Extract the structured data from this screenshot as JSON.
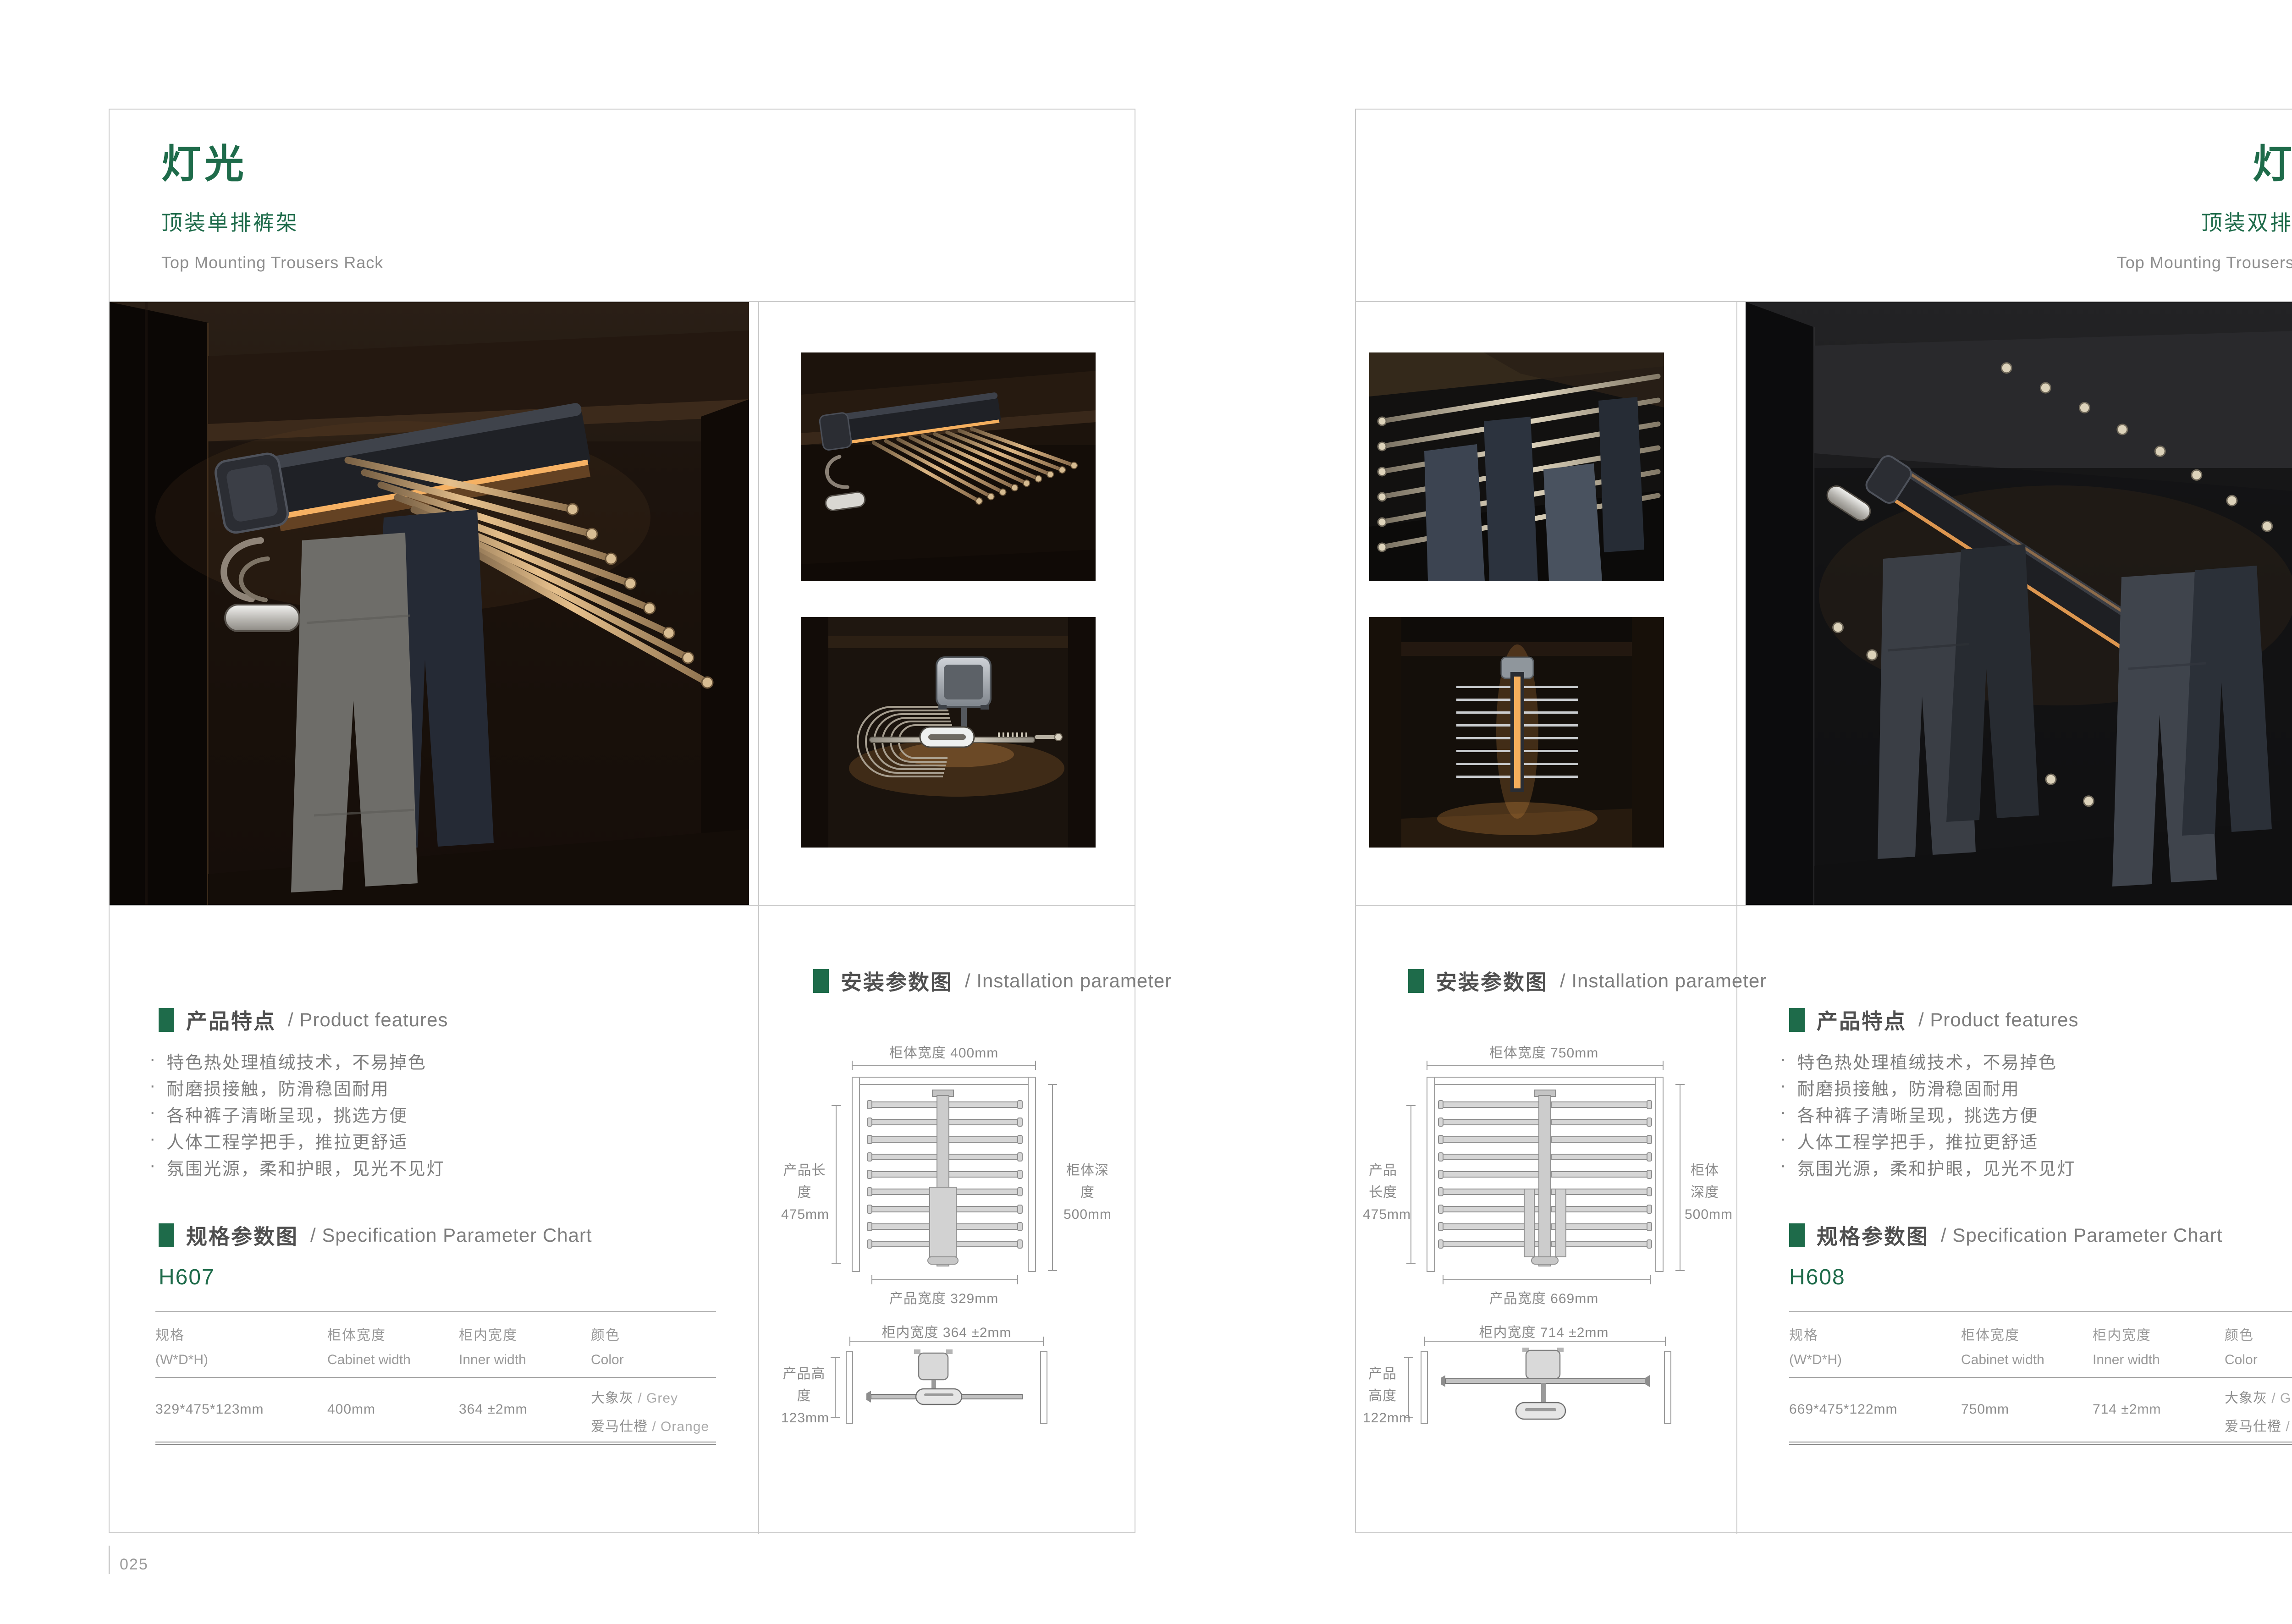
{
  "ui": {
    "bullet_glyph": "·",
    "accent_green": "#1e6b4a"
  },
  "shared": {
    "features_heading": {
      "zh": "产品特点",
      "en": "/  Product features"
    },
    "spec_heading": {
      "zh": "规格参数图",
      "en": "/ Specification Parameter Chart"
    },
    "install_heading": {
      "zh": "安装参数图",
      "en": "/  Installation parameter"
    },
    "feature_items": [
      "特色热处理植绒技术，不易掉色",
      "耐磨损接触，防滑稳固耐用",
      "各种裤子清晰呈现，挑选方便",
      "人体工程学把手，推拉更舒适",
      "氛围光源，柔和护眼，见光不见灯"
    ],
    "table_headers": [
      {
        "zh": "规格",
        "en": "(W*D*H)"
      },
      {
        "zh": "柜体宽度",
        "en": "Cabinet width"
      },
      {
        "zh": "柜内宽度",
        "en": "Inner width"
      },
      {
        "zh": "颜色",
        "en": "Color"
      }
    ]
  },
  "left_page": {
    "page_number": "025",
    "title": "灯光",
    "subtitle": "顶装单排裤架",
    "subtitle_en": "Top Mounting Trousers Rack",
    "model": "H607",
    "table_row": {
      "size": "329*475*123mm",
      "cabinet_width": "400mm",
      "inner_width": "364 ±2mm",
      "colors": [
        {
          "zh": "大象灰",
          "en": "/ Grey"
        },
        {
          "zh": "爱马仕橙",
          "en": "/ Orange"
        }
      ]
    },
    "install": {
      "top_view": {
        "cabinet_width": "柜体宽度 400mm",
        "product_length_label": "产品长度",
        "product_length_value": "475mm",
        "cabinet_depth_label": "柜体深度",
        "cabinet_depth_value": "500mm",
        "product_width": "产品宽度 329mm"
      },
      "side_view": {
        "inner_width": "柜内宽度 364 ±2mm",
        "product_height_label": "产品高度",
        "product_height_value": "123mm"
      }
    }
  },
  "right_page": {
    "page_number": "026",
    "title": "灯光",
    "subtitle": "顶装双排裤架",
    "subtitle_en": "Top Mounting Trousers Rack",
    "model": "H608",
    "table_row": {
      "size": "669*475*122mm",
      "cabinet_width": "750mm",
      "inner_width": "714 ±2mm",
      "colors": [
        {
          "zh": "大象灰",
          "en": "/ Grey"
        },
        {
          "zh": "爱马仕橙",
          "en": "/ Orange"
        }
      ]
    },
    "install": {
      "top_view": {
        "cabinet_width": "柜体宽度 750mm",
        "product_length_label": "产品长度",
        "product_length_value": "475mm",
        "cabinet_depth_label": "柜体深度",
        "cabinet_depth_value": "500mm",
        "product_width": "产品宽度 669mm"
      },
      "side_view": {
        "inner_width": "柜内宽度 714 ±2mm",
        "product_height_label": "产品高度",
        "product_height_value": "122mm"
      }
    }
  }
}
